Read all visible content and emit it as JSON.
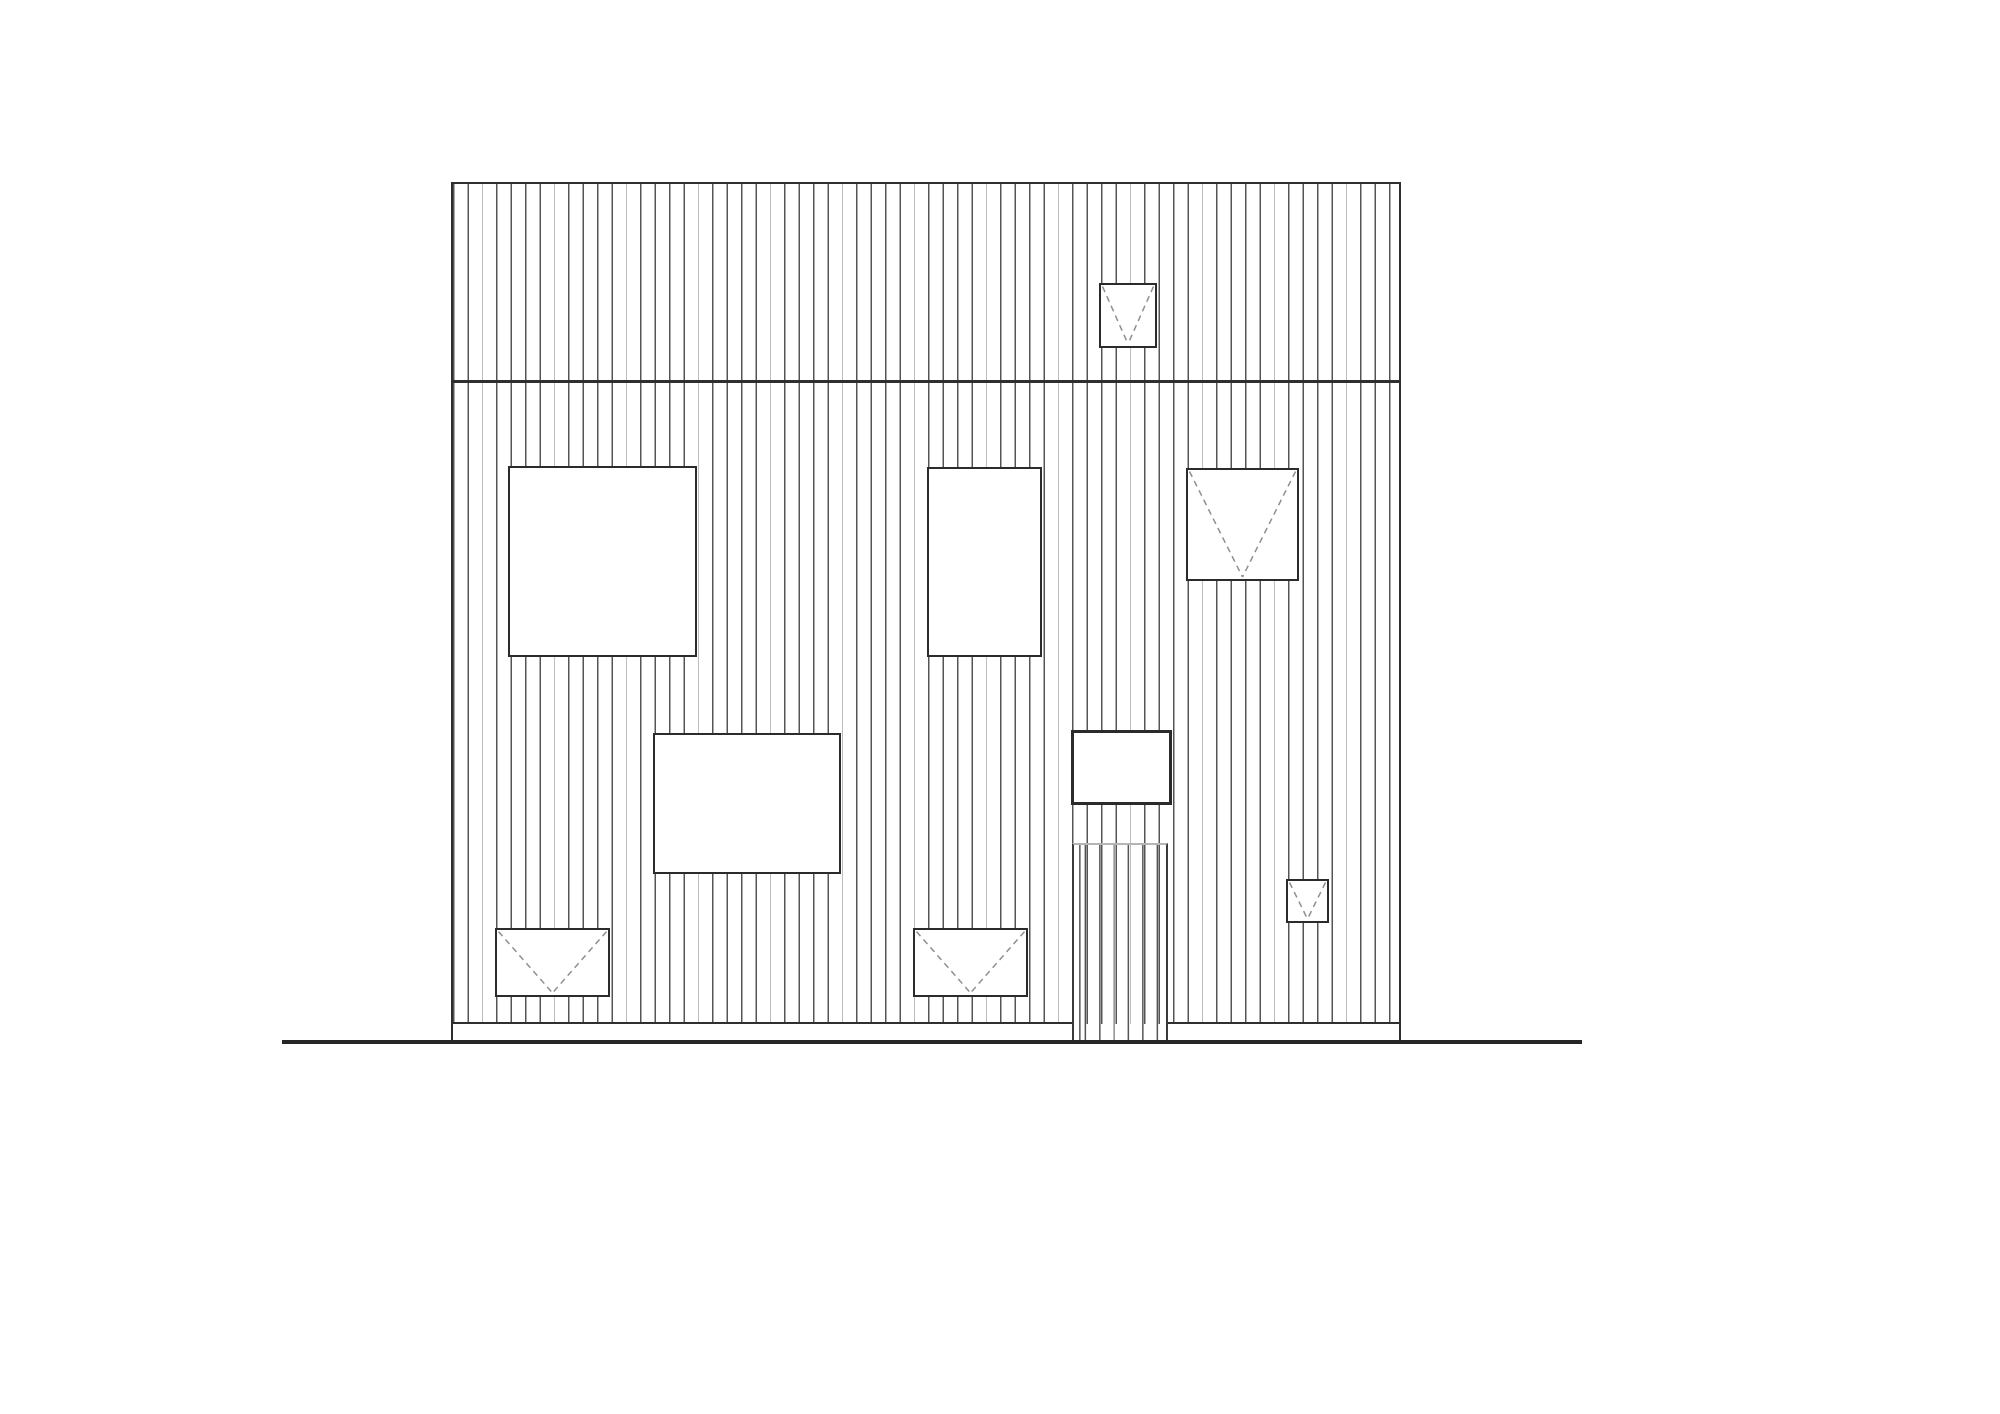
{
  "drawing": {
    "kind": "architectural-front-elevation",
    "cladding": "vertical-board-siding",
    "colors": {
      "background": "#ffffff",
      "outline": "#2f2f2f",
      "siding_line": "#545454",
      "siding_line_light": "#adadad",
      "window_border": "#2b2b2b",
      "hinge_dash": "#8f8f8f",
      "door_header": "#b5b5b5",
      "ground_line": "#262626"
    },
    "siding": {
      "line_spacing_px": 14.4,
      "line_width_px": 1.4,
      "light_line_every": 5
    },
    "facade": {
      "x": 451,
      "y": 182,
      "width": 950,
      "height": 842,
      "band_joint_y": 381
    },
    "door": {
      "x": 1072,
      "y": 843,
      "width": 96,
      "height": 199,
      "clad_with_siding": true
    },
    "plinth": {
      "top_y": 1022,
      "bottom_y": 1043,
      "left_segment": [
        451,
        1072
      ],
      "right_segment": [
        1168,
        1401
      ]
    },
    "ground_line": {
      "x1": 282,
      "x2": 1582,
      "y": 1040
    },
    "windows": [
      {
        "id": "window-upper-band-small",
        "x": 1099,
        "y": 283,
        "w": 58,
        "h": 65,
        "hinge_mark": true,
        "border": 2.2
      },
      {
        "id": "window-left-large-square",
        "x": 508,
        "y": 466,
        "w": 189,
        "h": 191,
        "hinge_mark": false,
        "border": 2.2
      },
      {
        "id": "window-middle-tall",
        "x": 927,
        "y": 467,
        "w": 115,
        "h": 190,
        "hinge_mark": false,
        "border": 2.2
      },
      {
        "id": "window-right-square",
        "x": 1186,
        "y": 468,
        "w": 113,
        "h": 113,
        "hinge_mark": true,
        "border": 2.2
      },
      {
        "id": "window-lower-middle-wide",
        "x": 653,
        "y": 733,
        "w": 188,
        "h": 141,
        "hinge_mark": false,
        "border": 2.2
      },
      {
        "id": "window-above-door",
        "x": 1071,
        "y": 730,
        "w": 101,
        "h": 75,
        "hinge_mark": false,
        "border": 3
      },
      {
        "id": "window-small-lower-right",
        "x": 1286,
        "y": 879,
        "w": 43,
        "h": 44,
        "hinge_mark": true,
        "border": 2.2
      },
      {
        "id": "window-bottom-left",
        "x": 495,
        "y": 928,
        "w": 115,
        "h": 69,
        "hinge_mark": true,
        "border": 2.2
      },
      {
        "id": "window-bottom-middle",
        "x": 913,
        "y": 928,
        "w": 115,
        "h": 69,
        "hinge_mark": true,
        "border": 2.2
      }
    ]
  }
}
